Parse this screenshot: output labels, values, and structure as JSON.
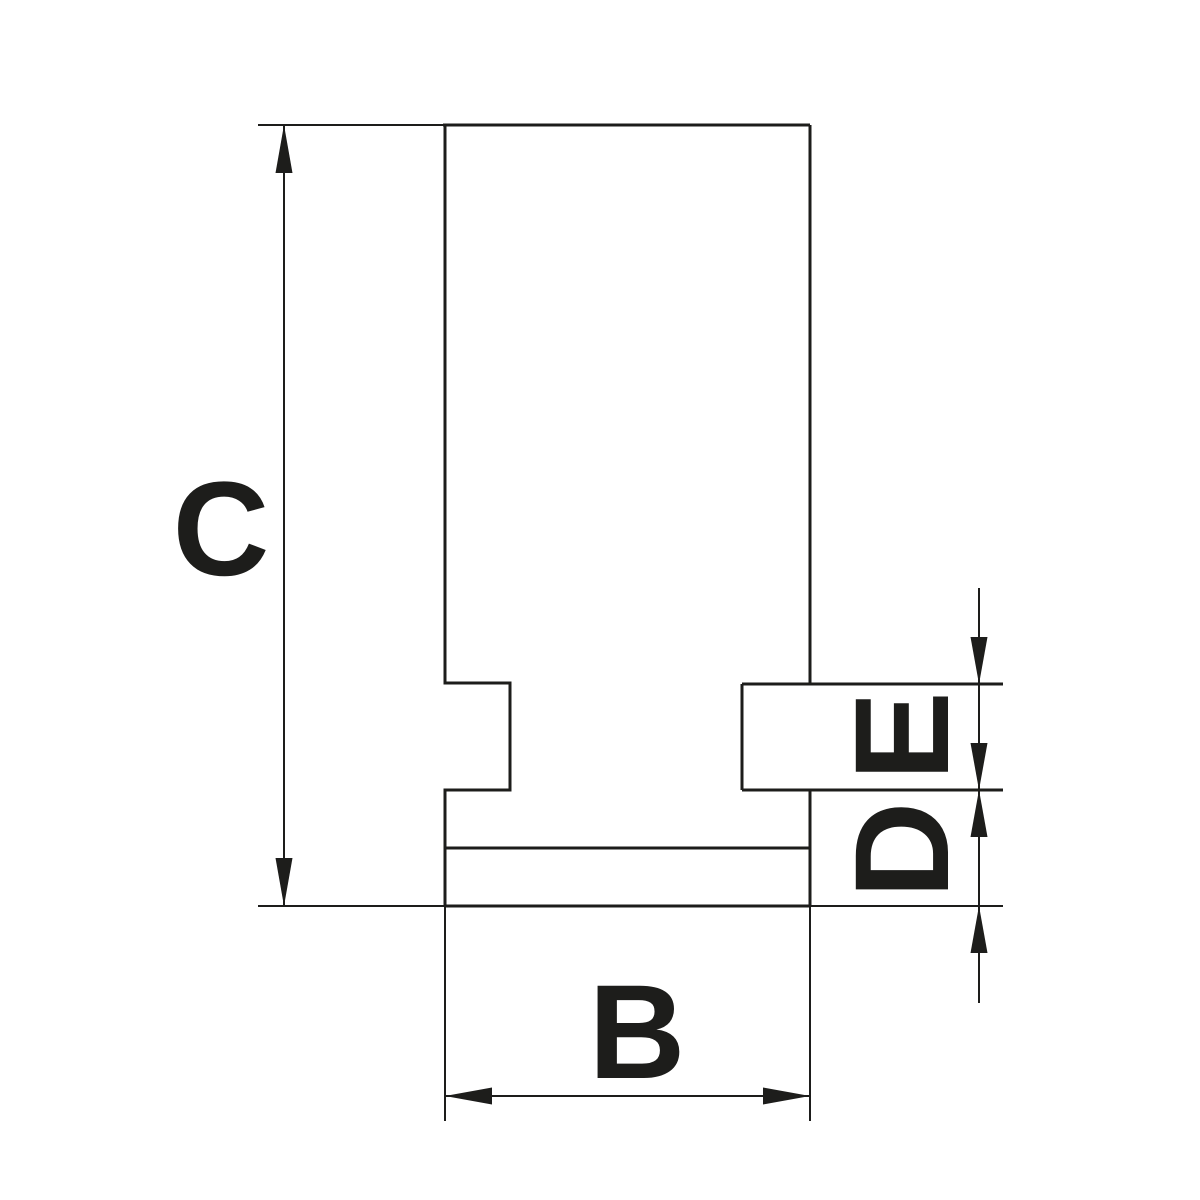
{
  "colors": {
    "ink": "#1d1d1b",
    "background": "#ffffff"
  },
  "dimensions": {
    "height_label": "C",
    "width_label": "B",
    "key_height_label": "E",
    "base_height_label": "D"
  }
}
